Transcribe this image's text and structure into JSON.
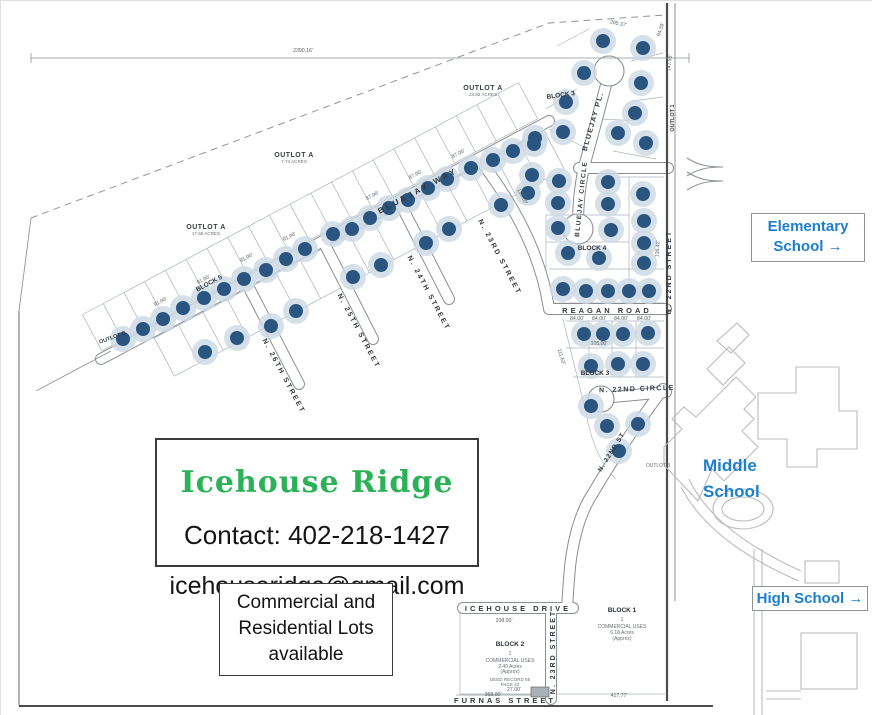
{
  "palette": {
    "title_green": "#2bb257",
    "school_blue": "#1b7fd0",
    "dot_navy": "#2a5580",
    "dot_halo": "#cdd9e4",
    "map_line": "#8a8f94",
    "boundary_dark": "#4c4c4c"
  },
  "boxes": {
    "contact": {
      "title": "Icehouse Ridge",
      "phone": "Contact: 402-218-1427",
      "email": "icehouseridge@gmail.com"
    },
    "availability": "Commercial and\nResidential Lots\navailable",
    "schools": {
      "elementary": "Elementary\nSchool →",
      "middle": "Middle\nSchool",
      "high": "High School →"
    }
  },
  "map": {
    "streets": [
      {
        "t": "BLUEJAY WAY",
        "x": 418,
        "y": 192,
        "r": -28,
        "fs": 8,
        "ls": 3
      },
      {
        "t": "N. 26TH STREET",
        "x": 281,
        "y": 376,
        "r": 62,
        "fs": 7,
        "ls": 2
      },
      {
        "t": "N. 25TH STREET",
        "x": 356,
        "y": 331,
        "r": 62,
        "fs": 7,
        "ls": 2
      },
      {
        "t": "N. 24TH STREET",
        "x": 426,
        "y": 293,
        "r": 62,
        "fs": 7,
        "ls": 2
      },
      {
        "t": "N. 23RD STREET",
        "x": 497,
        "y": 257,
        "r": 62,
        "fs": 7,
        "ls": 2
      },
      {
        "t": "BLUEJAY PL.",
        "x": 594,
        "y": 121,
        "r": -74,
        "fs": 7,
        "ls": 1.5
      },
      {
        "t": "BLUEJAY CIRCLE",
        "x": 582,
        "y": 198,
        "r": -84,
        "fs": 6.5,
        "ls": 1.5
      },
      {
        "t": "REAGAN ROAD",
        "x": 606,
        "y": 312,
        "r": 0,
        "fs": 7.5,
        "ls": 3
      },
      {
        "t": "N. 22ND STREET",
        "x": 670,
        "y": 271,
        "r": -90,
        "fs": 7,
        "ls": 2
      },
      {
        "t": "N. 22ND CIRCLE",
        "x": 636,
        "y": 390,
        "r": -2,
        "fs": 7,
        "ls": 1.5
      },
      {
        "t": "N. 22ND ST",
        "x": 612,
        "y": 452,
        "r": -58,
        "fs": 6.5,
        "ls": 1
      },
      {
        "t": "ICEHOUSE DRIVE",
        "x": 517,
        "y": 610,
        "r": 0,
        "fs": 7.5,
        "ls": 3
      },
      {
        "t": "N. 23RD STREET",
        "x": 554,
        "y": 651,
        "r": -90,
        "fs": 7,
        "ls": 2
      },
      {
        "t": "FURNAS STREET",
        "x": 504,
        "y": 702,
        "r": 0,
        "fs": 7.5,
        "ls": 3
      }
    ],
    "labels": [
      {
        "t": "BLOCK 3",
        "x": 560,
        "y": 96,
        "r": -8,
        "cls": "block",
        "fs": 6.5
      },
      {
        "t": "BLOCK 5",
        "x": 209,
        "y": 284,
        "r": -28,
        "cls": "block",
        "fs": 6.5
      },
      {
        "t": "BLOCK 4",
        "x": 591,
        "y": 249,
        "r": 0,
        "cls": "block",
        "fs": 6.5
      },
      {
        "t": "BLOCK 3",
        "x": 594,
        "y": 374,
        "r": 0,
        "cls": "block",
        "fs": 6.5
      },
      {
        "t": "BLOCK 1",
        "x": 621,
        "y": 611,
        "r": 0,
        "cls": "block",
        "fs": 6.5
      },
      {
        "t": "1",
        "x": 621,
        "y": 620,
        "r": 0,
        "cls": "tiny",
        "fs": 5
      },
      {
        "t": "COMMERCIAL USES",
        "x": 621,
        "y": 627,
        "r": 0,
        "cls": "tiny",
        "fs": 5
      },
      {
        "t": "6.18 Acres",
        "x": 621,
        "y": 633,
        "r": 0,
        "cls": "tiny",
        "fs": 5
      },
      {
        "t": "(Approx)",
        "x": 621,
        "y": 639,
        "r": 0,
        "cls": "tiny",
        "fs": 5
      },
      {
        "t": "BLOCK 2",
        "x": 509,
        "y": 645,
        "r": 0,
        "cls": "block",
        "fs": 6.5
      },
      {
        "t": "1",
        "x": 509,
        "y": 654,
        "r": 0,
        "cls": "tiny",
        "fs": 5
      },
      {
        "t": "COMMERCIAL USES",
        "x": 509,
        "y": 661,
        "r": 0,
        "cls": "tiny",
        "fs": 5
      },
      {
        "t": "2.49 Acres",
        "x": 509,
        "y": 667,
        "r": 0,
        "cls": "tiny",
        "fs": 5
      },
      {
        "t": "(Approx)",
        "x": 509,
        "y": 672,
        "r": 0,
        "cls": "tiny",
        "fs": 5
      },
      {
        "t": "DEED RECORD 65",
        "x": 509,
        "y": 680,
        "r": 0,
        "cls": "tiny",
        "fs": 4.6
      },
      {
        "t": "PAGE 42",
        "x": 509,
        "y": 685,
        "r": 0,
        "cls": "tiny",
        "fs": 4.6
      },
      {
        "t": "OUTLOT A",
        "x": 482,
        "y": 89,
        "r": 0,
        "cls": "outlot",
        "fs": 7
      },
      {
        "t": "23.92 ACRES",
        "x": 482,
        "y": 95,
        "r": 0,
        "cls": "tiny",
        "fs": 4.6
      },
      {
        "t": "OUTLOT A",
        "x": 293,
        "y": 156,
        "r": 0,
        "cls": "outlot",
        "fs": 7
      },
      {
        "t": "7.74 ACRES",
        "x": 293,
        "y": 162,
        "r": 0,
        "cls": "tiny",
        "fs": 4.6
      },
      {
        "t": "OUTLOT A",
        "x": 205,
        "y": 228,
        "r": 0,
        "cls": "outlot",
        "fs": 7
      },
      {
        "t": "17.65 ACRES",
        "x": 205,
        "y": 234,
        "r": 0,
        "cls": "tiny",
        "fs": 4.6
      },
      {
        "t": "OUTLOT B",
        "x": 112,
        "y": 338,
        "r": -20,
        "cls": "outlot-sm",
        "fs": 5.5
      },
      {
        "t": "OUTLOT 1",
        "x": 673,
        "y": 117,
        "r": -90,
        "cls": "outlot-sm",
        "fs": 5.5
      },
      {
        "t": "OUTLOT 3",
        "x": 657,
        "y": 466,
        "r": 0,
        "cls": "tiny",
        "fs": 5
      }
    ],
    "dims": [
      {
        "t": "2390.16'",
        "x": 302,
        "y": 51,
        "r": 0
      },
      {
        "t": "91.00'",
        "x": 160,
        "y": 302,
        "r": -28
      },
      {
        "t": "91.00'",
        "x": 203,
        "y": 280,
        "r": -28
      },
      {
        "t": "91.00'",
        "x": 246,
        "y": 258,
        "r": -28
      },
      {
        "t": "91.00'",
        "x": 289,
        "y": 237,
        "r": -28
      },
      {
        "t": "87.00'",
        "x": 372,
        "y": 196,
        "r": -28
      },
      {
        "t": "87.00'",
        "x": 415,
        "y": 175,
        "r": -28
      },
      {
        "t": "87.00'",
        "x": 458,
        "y": 154,
        "r": -28
      },
      {
        "t": "84.00'",
        "x": 576,
        "y": 319,
        "r": 0
      },
      {
        "t": "84.00'",
        "x": 598,
        "y": 319,
        "r": 0
      },
      {
        "t": "84.00'",
        "x": 620,
        "y": 319,
        "r": 0
      },
      {
        "t": "84.00'",
        "x": 643,
        "y": 319,
        "r": 0
      },
      {
        "t": "105.00'",
        "x": 598,
        "y": 344,
        "r": 0
      },
      {
        "t": "205.37'",
        "x": 617,
        "y": 24,
        "r": 12
      },
      {
        "t": "94.39'",
        "x": 661,
        "y": 29,
        "r": -72
      },
      {
        "t": "147.55'",
        "x": 670,
        "y": 62,
        "r": -84
      },
      {
        "t": "136.42'",
        "x": 658,
        "y": 248,
        "r": -86
      },
      {
        "t": "111.63'",
        "x": 559,
        "y": 356,
        "r": 72
      },
      {
        "t": "130.00'",
        "x": 520,
        "y": 196,
        "r": 62
      },
      {
        "t": "208.00'",
        "x": 503,
        "y": 621,
        "r": 0
      },
      {
        "t": "368.00'",
        "x": 492,
        "y": 695,
        "r": 0
      },
      {
        "t": "417.77'",
        "x": 618,
        "y": 696,
        "r": 0
      },
      {
        "t": "27.00'",
        "x": 513,
        "y": 690,
        "r": 0
      }
    ],
    "dot_style": {
      "r": 7,
      "halo": 13
    },
    "dots": [
      [
        122,
        338
      ],
      [
        142,
        328
      ],
      [
        162,
        318
      ],
      [
        182,
        307
      ],
      [
        203,
        297
      ],
      [
        223,
        288
      ],
      [
        243,
        278
      ],
      [
        265,
        269
      ],
      [
        285,
        258
      ],
      [
        304,
        248
      ],
      [
        332,
        233
      ],
      [
        351,
        228
      ],
      [
        369,
        217
      ],
      [
        388,
        207
      ],
      [
        407,
        199
      ],
      [
        427,
        187
      ],
      [
        446,
        178
      ],
      [
        470,
        167
      ],
      [
        492,
        159
      ],
      [
        512,
        150
      ],
      [
        533,
        143
      ],
      [
        204,
        351
      ],
      [
        236,
        337
      ],
      [
        270,
        325
      ],
      [
        295,
        310
      ],
      [
        352,
        276
      ],
      [
        380,
        264
      ],
      [
        425,
        242
      ],
      [
        448,
        228
      ],
      [
        500,
        204
      ],
      [
        527,
        192
      ],
      [
        602,
        40
      ],
      [
        642,
        47
      ],
      [
        583,
        72
      ],
      [
        640,
        82
      ],
      [
        565,
        101
      ],
      [
        634,
        112
      ],
      [
        562,
        131
      ],
      [
        617,
        132
      ],
      [
        645,
        142
      ],
      [
        534,
        137
      ],
      [
        531,
        174
      ],
      [
        558,
        180
      ],
      [
        607,
        181
      ],
      [
        557,
        202
      ],
      [
        607,
        203
      ],
      [
        642,
        193
      ],
      [
        557,
        227
      ],
      [
        610,
        229
      ],
      [
        643,
        220
      ],
      [
        567,
        252
      ],
      [
        598,
        257
      ],
      [
        643,
        242
      ],
      [
        643,
        262
      ],
      [
        562,
        288
      ],
      [
        585,
        290
      ],
      [
        607,
        290
      ],
      [
        628,
        290
      ],
      [
        648,
        290
      ],
      [
        583,
        333
      ],
      [
        602,
        333
      ],
      [
        622,
        333
      ],
      [
        647,
        332
      ],
      [
        590,
        365
      ],
      [
        617,
        363
      ],
      [
        642,
        363
      ],
      [
        590,
        405
      ],
      [
        606,
        425
      ],
      [
        637,
        423
      ],
      [
        618,
        450
      ]
    ],
    "strips": [
      {
        "x1": 104,
        "y1": 356,
        "x2": 540,
        "y2": 124,
        "o1": -7,
        "o2": -48,
        "ticks": 21
      },
      {
        "x1": 150,
        "y1": 331,
        "x2": 540,
        "y2": 124,
        "o1": 7,
        "o2": 50,
        "ticks": 16
      }
    ]
  }
}
